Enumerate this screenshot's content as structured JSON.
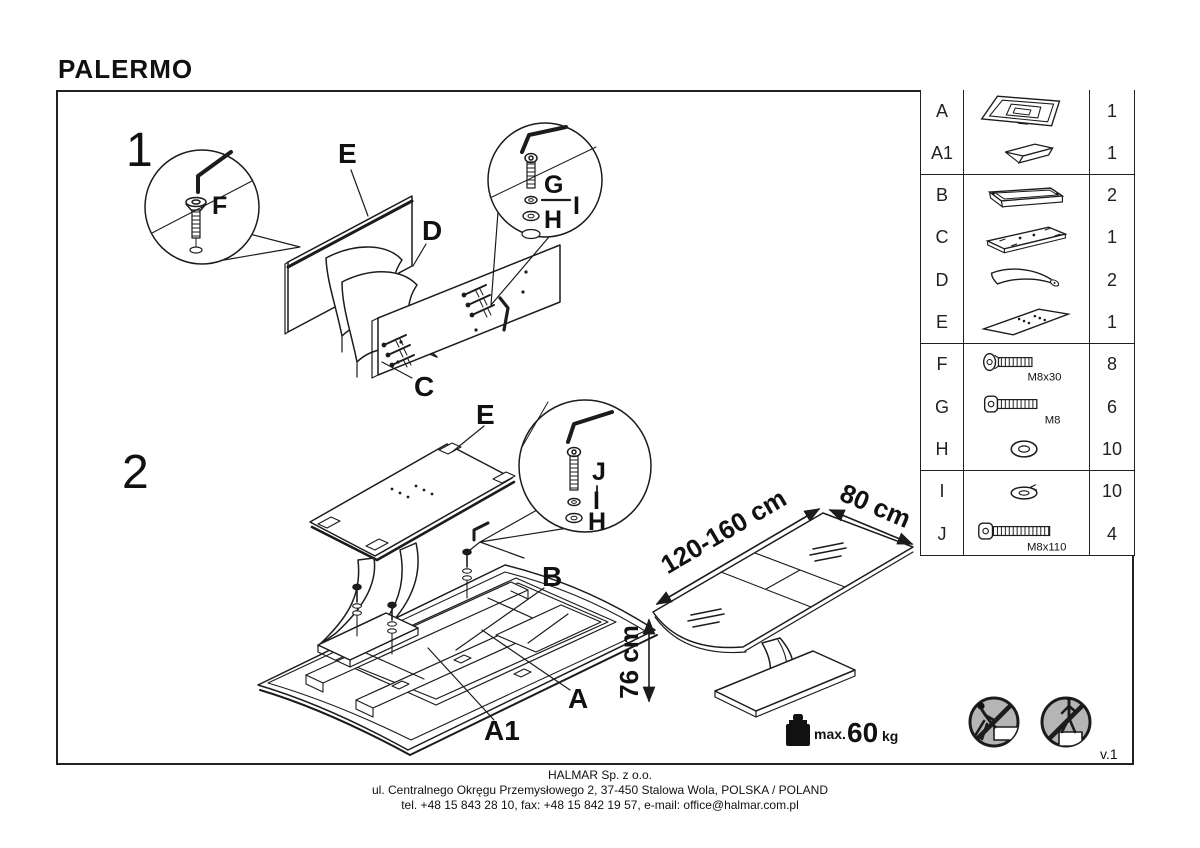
{
  "title": "PALERMO",
  "version": "v.1",
  "colors": {
    "line": "#1c1c1c",
    "warning_fill": "#b5b5b5"
  },
  "steps": {
    "step1": "1",
    "step2": "2"
  },
  "labels": {
    "step1": {
      "e": "E",
      "d": "D",
      "c": "C",
      "f": "F",
      "g": "G",
      "i": "I",
      "h": "H"
    },
    "step2": {
      "e": "E",
      "j": "J",
      "i": "I",
      "h": "H",
      "b": "B",
      "a": "A",
      "a1": "A1"
    }
  },
  "parts_table": {
    "rows": [
      {
        "id": "A",
        "icon": "table-base-assembly",
        "spec": "",
        "qty": "1"
      },
      {
        "id": "A1",
        "icon": "extension-leaf",
        "spec": "",
        "qty": "1"
      },
      {
        "id": "B",
        "icon": "frame-rail",
        "spec": "",
        "qty": "2"
      },
      {
        "id": "C",
        "icon": "base-plate",
        "spec": "",
        "qty": "1"
      },
      {
        "id": "D",
        "icon": "curved-leg",
        "spec": "",
        "qty": "2"
      },
      {
        "id": "E",
        "icon": "mounting-panel",
        "spec": "",
        "qty": "1"
      },
      {
        "id": "F",
        "icon": "countersunk-bolt",
        "spec": "M8x30",
        "qty": "8"
      },
      {
        "id": "G",
        "icon": "button-head-bolt",
        "spec": "M8",
        "qty": "6"
      },
      {
        "id": "H",
        "icon": "flat-washer",
        "spec": "",
        "qty": "10"
      },
      {
        "id": "I",
        "icon": "spring-washer",
        "spec": "",
        "qty": "10"
      },
      {
        "id": "J",
        "icon": "socket-head-bolt",
        "spec": "M8x110",
        "qty": "4"
      }
    ]
  },
  "dimensions": {
    "length": "120-160 cm",
    "width": "80 cm",
    "height": "76 cm"
  },
  "load_limit": {
    "prefix": "max.",
    "value": "60",
    "unit": "kg"
  },
  "icons": [
    "allen-key-icon",
    "magnifier-circle",
    "weight-icon",
    "no-climbing-icon",
    "no-standing-icon"
  ],
  "footer": {
    "company": "HALMAR Sp. z o.o.",
    "address": "ul. Centralnego Okręgu Przemysłowego 2, 37-450 Stalowa Wola, POLSKA / POLAND",
    "contact": "tel. +48 15 843 28 10, fax: +48 15 842 19 57, e-mail: office@halmar.com.pl"
  }
}
